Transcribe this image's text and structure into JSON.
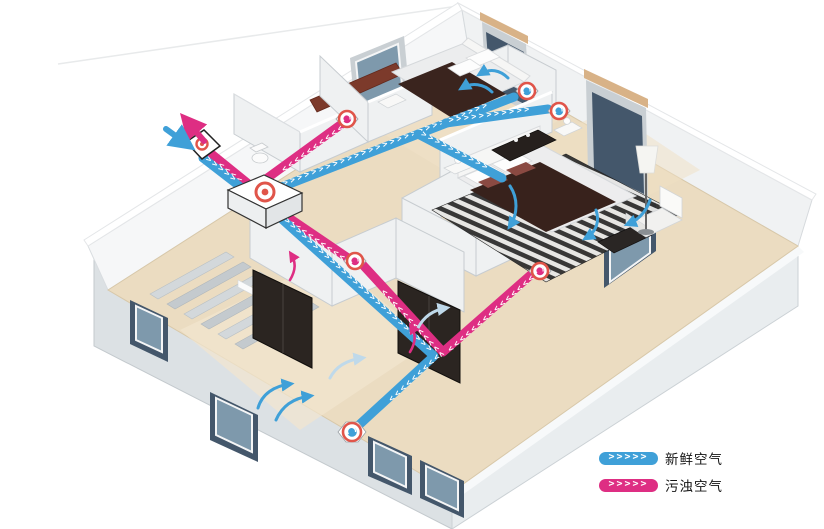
{
  "legend": {
    "items": [
      {
        "id": "fresh_air",
        "label": "新鲜空气",
        "color": "#3FA0D8",
        "chevrons": 5
      },
      {
        "id": "exhaust_air",
        "label": "污浊空气",
        "color": "#DE2E83",
        "chevrons": 5
      }
    ],
    "chevron_glyph": ">"
  },
  "colors": {
    "fresh_air": "#3FA0D8",
    "exhaust_air": "#DE2E83",
    "diffuser_ring": "#E0554A",
    "floor": "#EBDCC1",
    "wall_face": "#F1F3F4",
    "window_glass": "#7E99AC",
    "background": "#FFFFFF"
  },
  "scene": {
    "type": "isometric-house-ventilation-diagram",
    "rooms": [
      "bedroom",
      "master-bedroom",
      "bathroom",
      "hallway",
      "living-room",
      "staircase"
    ],
    "equipment": {
      "hrv_unit_count": 1,
      "outdoor_wall_vent_count": 1,
      "supply_diffuser_count": 3,
      "exhaust_grille_count": 3
    },
    "airflows": [
      {
        "id": "fresh-supply",
        "color_ref": "fresh_air",
        "route": "outdoor vent → unit → bedroom / master bedroom / living room diffusers"
      },
      {
        "id": "exhaust-return",
        "color_ref": "exhaust_air",
        "route": "room grilles → unit → outdoor vent"
      }
    ]
  }
}
